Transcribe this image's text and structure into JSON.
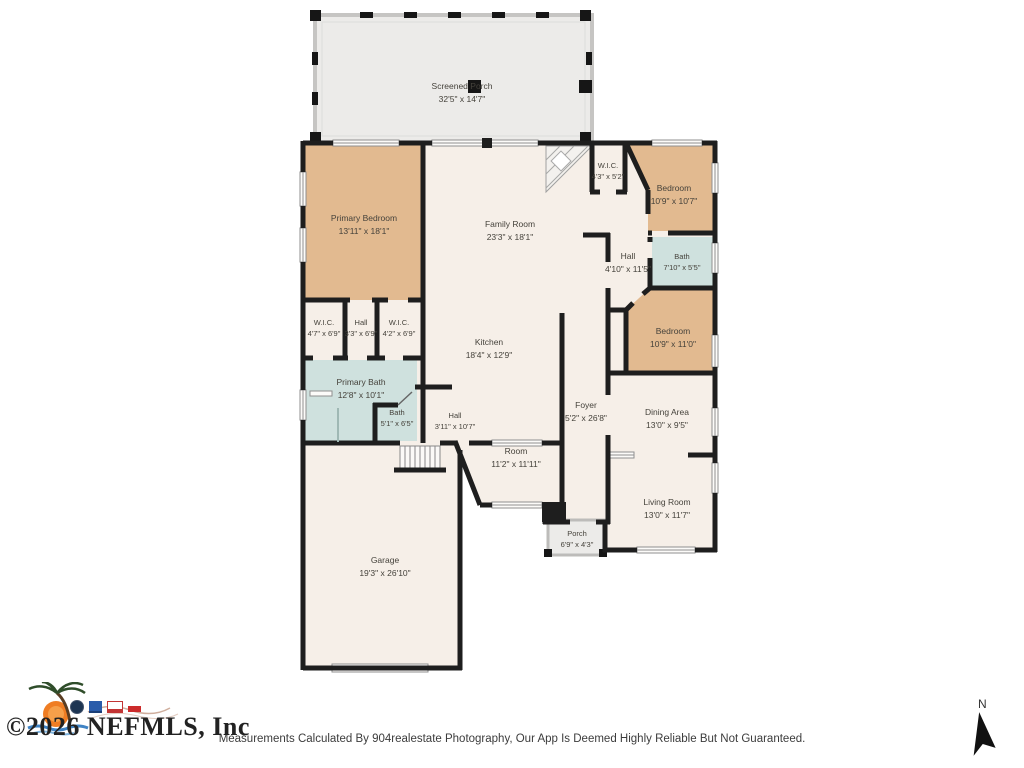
{
  "rooms": [
    {
      "id": "screened-porch",
      "name": "Screened Porch",
      "dims": "32'5\" x 14'7\""
    },
    {
      "id": "primary-bedroom",
      "name": "Primary Bedroom",
      "dims": "13'11\" x 18'1\""
    },
    {
      "id": "family-room",
      "name": "Family Room",
      "dims": "23'3\" x 18'1\""
    },
    {
      "id": "wic-north",
      "name": "W.I.C.",
      "dims": "4'3\" x 5'2\""
    },
    {
      "id": "bedroom-ne",
      "name": "Bedroom",
      "dims": "10'9\" x 10'7\""
    },
    {
      "id": "hall-east",
      "name": "Hall",
      "dims": "4'10\" x 11'5\""
    },
    {
      "id": "bath-east",
      "name": "Bath",
      "dims": "7'10\" x 5'5\""
    },
    {
      "id": "bedroom-se",
      "name": "Bedroom",
      "dims": "10'9\" x 11'0\""
    },
    {
      "id": "wic-west",
      "name": "W.I.C.",
      "dims": "4'7\" x 6'9\""
    },
    {
      "id": "hall-center",
      "name": "Hall",
      "dims": "3'3\" x 6'9\""
    },
    {
      "id": "wic-center",
      "name": "W.I.C.",
      "dims": "4'2\" x 6'9\""
    },
    {
      "id": "kitchen",
      "name": "Kitchen",
      "dims": "18'4\" x 12'9\""
    },
    {
      "id": "primary-bath",
      "name": "Primary Bath",
      "dims": "12'8\" x 10'1\""
    },
    {
      "id": "bath-small",
      "name": "Bath",
      "dims": "5'1\" x 6'5\""
    },
    {
      "id": "hall-south",
      "name": "Hall",
      "dims": "3'11\" x 10'7\""
    },
    {
      "id": "foyer",
      "name": "Foyer",
      "dims": "5'2\" x 26'8\""
    },
    {
      "id": "dining-area",
      "name": "Dining Area",
      "dims": "13'0\" x 9'5\""
    },
    {
      "id": "room",
      "name": "Room",
      "dims": "11'2\" x 11'11\""
    },
    {
      "id": "living-room",
      "name": "Living Room",
      "dims": "13'0\" x 11'7\""
    },
    {
      "id": "porch",
      "name": "Porch",
      "dims": "6'9\" x 4'3\""
    },
    {
      "id": "garage",
      "name": "Garage",
      "dims": "19'3\" x 26'10\""
    }
  ],
  "footer": {
    "copyright": "©2026 NEFMLS, Inc",
    "disclaimer": "Measurements Calculated By 904realestate Photography, Our App Is Deemed Highly Reliable But Not Guaranteed."
  },
  "compass": {
    "label": "N"
  },
  "colors": {
    "bedroom_fill": "#e2ba90",
    "bath_fill": "#cfe1de",
    "floor_fill": "#f6efe8",
    "porch_fill": "#ecebe9",
    "wall": "#1e1e1e"
  }
}
